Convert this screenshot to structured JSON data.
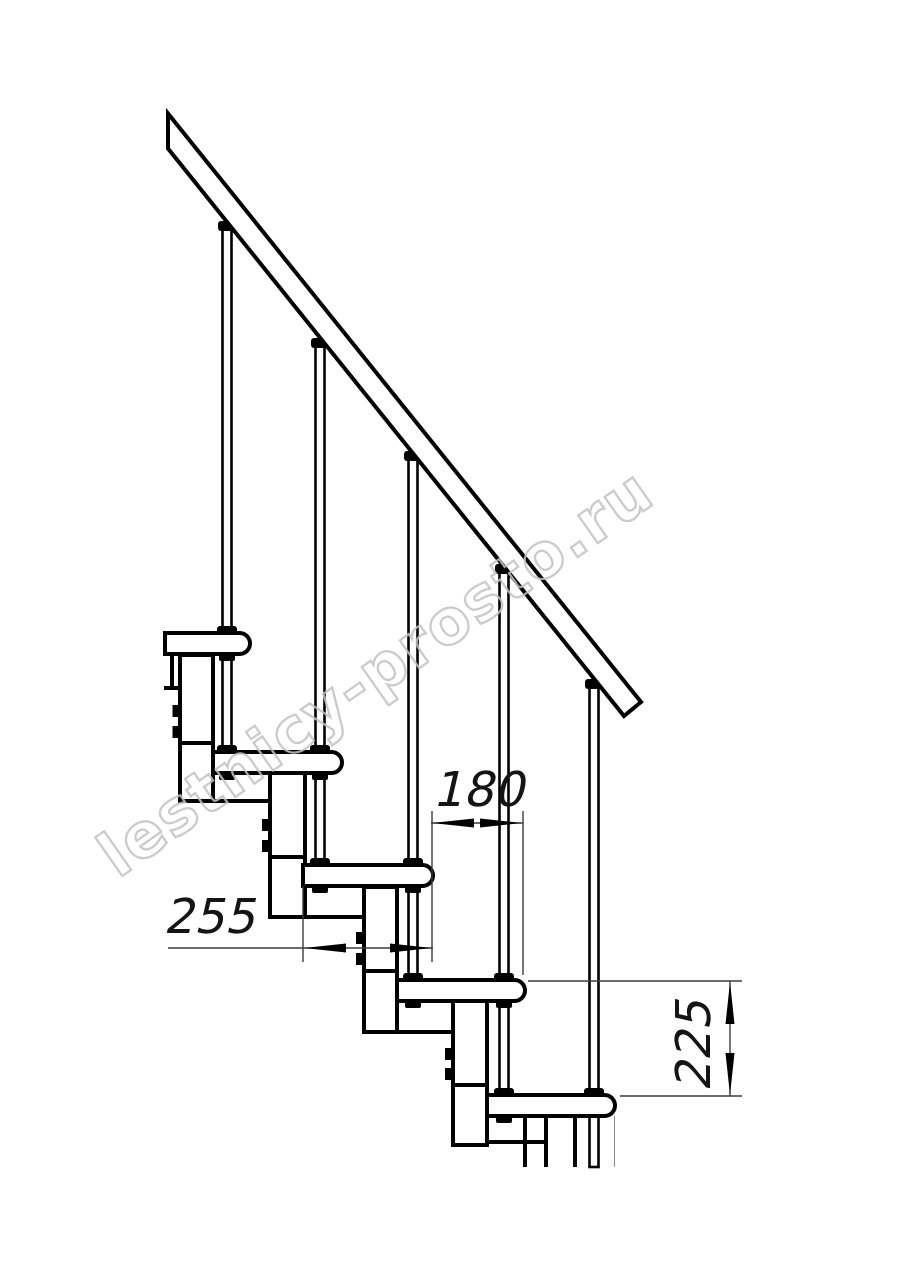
{
  "drawing": {
    "background": "#ffffff",
    "line_color": "#000000",
    "dimension_text_color": "#141414",
    "dimensions": {
      "tread_depth": {
        "label": "255",
        "orientation": "horizontal"
      },
      "going": {
        "label": "180",
        "orientation": "horizontal"
      },
      "rise": {
        "label": "225",
        "orientation": "vertical"
      }
    },
    "watermark": {
      "text": "lestnicy-prosto.ru",
      "color": "#c3c3c3"
    }
  }
}
